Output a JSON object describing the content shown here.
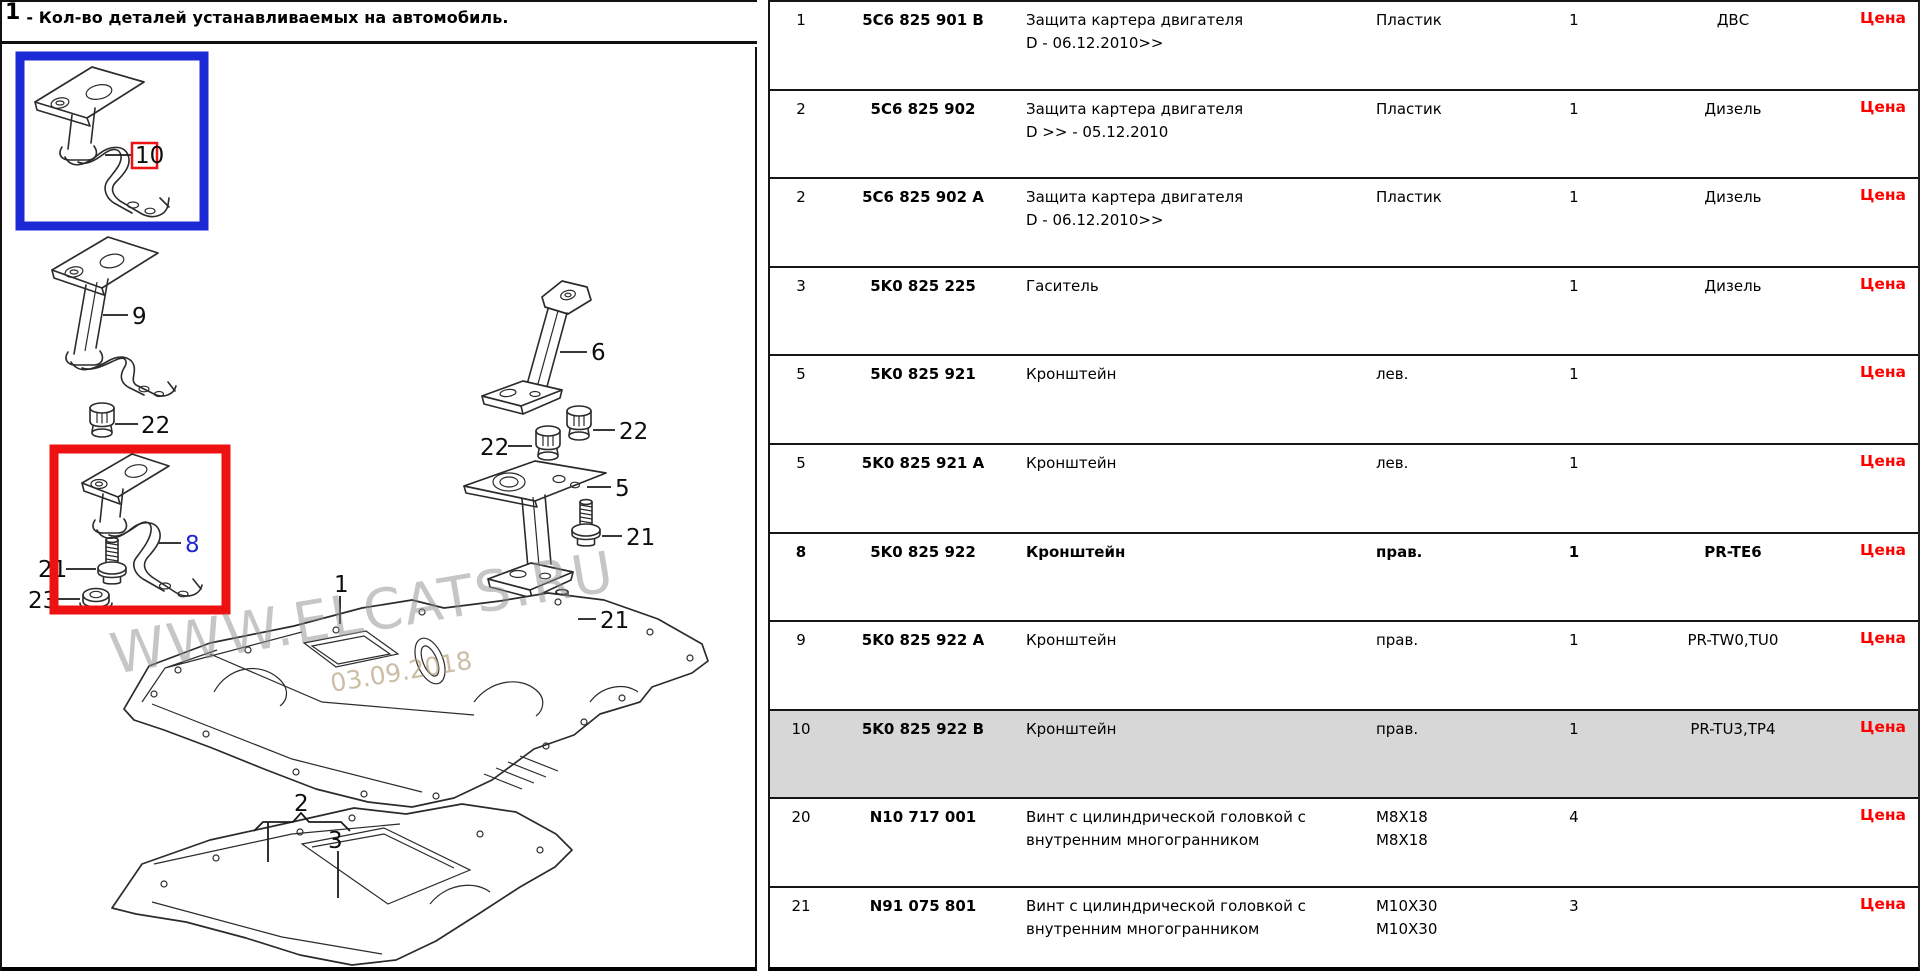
{
  "header": {
    "figure_ref": "1",
    "note": "- Кол-во деталей устанавливаемых на автомобиль."
  },
  "watermark": {
    "site": "WWW.ELCATS.RU",
    "date": "03.09.2018"
  },
  "colors": {
    "selection_blue": "#1b2ad4",
    "selection_red": "#ee1111",
    "price_red": "#ff0000",
    "row_highlight": "#d7d7d7"
  },
  "diagram": {
    "callouts": [
      {
        "label": "10"
      },
      {
        "label": "9"
      },
      {
        "label": "22"
      },
      {
        "label": "8"
      },
      {
        "label": "21"
      },
      {
        "label": "23"
      },
      {
        "label": "1"
      },
      {
        "label": "6"
      },
      {
        "label": "22"
      },
      {
        "label": "22"
      },
      {
        "label": "5"
      },
      {
        "label": "21"
      },
      {
        "label": "21"
      },
      {
        "label": "2"
      },
      {
        "label": "3"
      }
    ]
  },
  "table": {
    "price_label": "Цена",
    "rows": [
      {
        "pos": "1",
        "part_number": "5C6 825 901 B",
        "name": [
          "Защита картера двигателя",
          "D - 06.12.2010>>"
        ],
        "model": [
          "Пластик"
        ],
        "qty": "1",
        "modif": "ДВС",
        "bold": false,
        "highlighted": false
      },
      {
        "pos": "2",
        "part_number": "5C6 825 902",
        "name": [
          "Защита картера двигателя",
          "D >> - 05.12.2010"
        ],
        "model": [
          "Пластик"
        ],
        "qty": "1",
        "modif": "Дизель",
        "bold": false,
        "highlighted": false
      },
      {
        "pos": "2",
        "part_number": "5C6 825 902 A",
        "name": [
          "Защита картера двигателя",
          "D - 06.12.2010>>"
        ],
        "model": [
          "Пластик"
        ],
        "qty": "1",
        "modif": "Дизель",
        "bold": false,
        "highlighted": false
      },
      {
        "pos": "3",
        "part_number": "5K0 825 225",
        "name": [
          "Гаситель"
        ],
        "model": [],
        "qty": "1",
        "modif": "Дизель",
        "bold": false,
        "highlighted": false
      },
      {
        "pos": "5",
        "part_number": "5K0 825 921",
        "name": [
          "Кронштейн"
        ],
        "model": [
          "лев."
        ],
        "qty": "1",
        "modif": "",
        "bold": false,
        "highlighted": false
      },
      {
        "pos": "5",
        "part_number": "5K0 825 921 A",
        "name": [
          "Кронштейн"
        ],
        "model": [
          "лев."
        ],
        "qty": "1",
        "modif": "",
        "bold": false,
        "highlighted": false
      },
      {
        "pos": "8",
        "part_number": "5K0 825 922",
        "name": [
          "Кронштейн"
        ],
        "model": [
          "прав."
        ],
        "qty": "1",
        "modif": "PR-TE6",
        "bold": true,
        "highlighted": false
      },
      {
        "pos": "9",
        "part_number": "5K0 825 922 A",
        "name": [
          "Кронштейн"
        ],
        "model": [
          "прав."
        ],
        "qty": "1",
        "modif": "PR-TW0,TU0",
        "bold": false,
        "highlighted": false
      },
      {
        "pos": "10",
        "part_number": "5K0 825 922 B",
        "name": [
          "Кронштейн"
        ],
        "model": [
          "прав."
        ],
        "qty": "1",
        "modif": "PR-TU3,TP4",
        "bold": false,
        "highlighted": true
      },
      {
        "pos": "20",
        "part_number": "N10 717 001",
        "name": [
          "Винт с цилиндрической головкой с",
          "внутренним многогранником"
        ],
        "model": [
          "M8X18",
          "M8X18"
        ],
        "qty": "4",
        "modif": "",
        "bold": false,
        "highlighted": false
      },
      {
        "pos": "21",
        "part_number": "N91 075 801",
        "name": [
          "Винт с цилиндрической головкой с",
          "внутренним многогранником"
        ],
        "model": [
          "M10X30",
          "M10X30"
        ],
        "qty": "3",
        "modif": "",
        "bold": false,
        "highlighted": false
      }
    ]
  }
}
